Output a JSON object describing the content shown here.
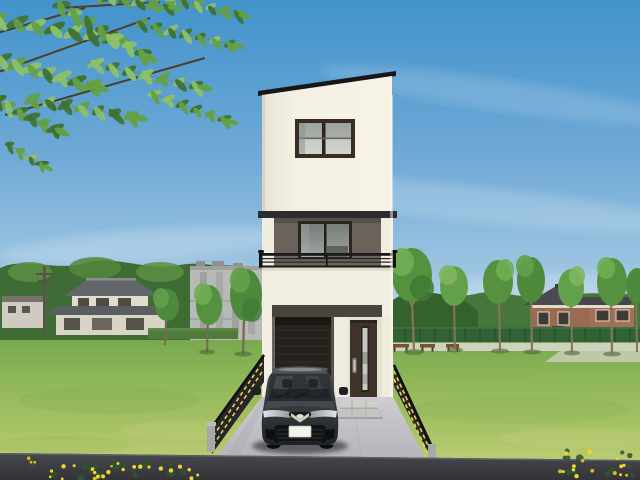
{
  "scene": {
    "type": "architectural-exterior-rendering",
    "labels": {
      "scene": "3D exterior rendering of a narrow three-story modern house with a front driveway and parked car, set beside a grassy park under a blue sky",
      "sky": "blue sky with thin wispy clouds",
      "foliage": "overhanging tree branch with green pinnate leaves",
      "left_background": "neighborhood with tiled-roof house and gray apartment building behind trees",
      "right_background": "park lawn with young trees, green fence, benches and a brown two-story house",
      "main_house": "three-story house, cream walls with dark gray accent floor and black mono-pitched roof",
      "third_floor_window": "two-pane sliding window with dark brown frame",
      "balcony": "second-floor balcony with black metal railing and large sliding glass door",
      "garage": "built-in garage with dark shutter",
      "front_door": "dark brown entrance door with vertical glass panel and silver handle",
      "entrance_steps": "light concrete entrance steps",
      "driveway": "concrete driveway flanked by black guard fences with yellow stripes",
      "car": "dark gray compact car parked facing the street",
      "road": "dark asphalt road in the foreground",
      "flowers": "yellow roadside wildflowers"
    },
    "license_plate_text": "",
    "park_tree_count": 7,
    "bench_count": 3,
    "guard_fence_count": 2
  },
  "colors": {
    "sky_top": "#4293CC",
    "sky_mid": "#6FA9D6",
    "sky_horizon": "#C9E2ED",
    "treeline": "#3E6C34",
    "tree_highlight": "#5C8F43",
    "field_far": "#79AC4F",
    "field_near": "#B9CB72",
    "jp_roof": "#62666B",
    "jp_wall": "#E0DCCE",
    "building": "#B7BAB6",
    "building_shade": "#9EA19D",
    "brown_house_wall": "#9C6A50",
    "brown_house_roof": "#46464C",
    "park_fence": "#316237",
    "path": "#D7D7C9",
    "bench": "#7A5038",
    "trunk": "#8A7458",
    "wall_cream": "#F2EEE1",
    "wall_cream_shade": "#DFDAC8",
    "accent_gray": "#6B635B",
    "roof_black": "#17171A",
    "frame_brown": "#382C23",
    "glass_top": "#9FA4A0",
    "glass_bottom": "#C6CBC5",
    "railing": "#1A1A1C",
    "garage": "#2A2420",
    "band_dark": "#4A443E",
    "door": "#3F332B",
    "door_glass": "#C4C8C2",
    "handle": "#C0C3C5",
    "step": "#CDD0CB",
    "step_shade": "#B5B8B3",
    "driveway_top": "#CFCDD3",
    "driveway_bottom": "#BAB8BF",
    "guardrail": "#26262B",
    "stripe": "#E8D44A",
    "post": "#A8A8A8",
    "road": "#3A3A40",
    "road_edge": "#5E5E66",
    "car_glass": "#2E3538",
    "lamp": "#D9DEE0",
    "chrome_green": "#C9D2BE",
    "plate": "#F4F4EF",
    "grille_dark": "#101213",
    "branch": "#4E3F28",
    "flower": "#EFD829",
    "flower_leaf": "#2F5530",
    "foliage": [
      "#3E7230",
      "#64A044",
      "#8CC167"
    ]
  }
}
